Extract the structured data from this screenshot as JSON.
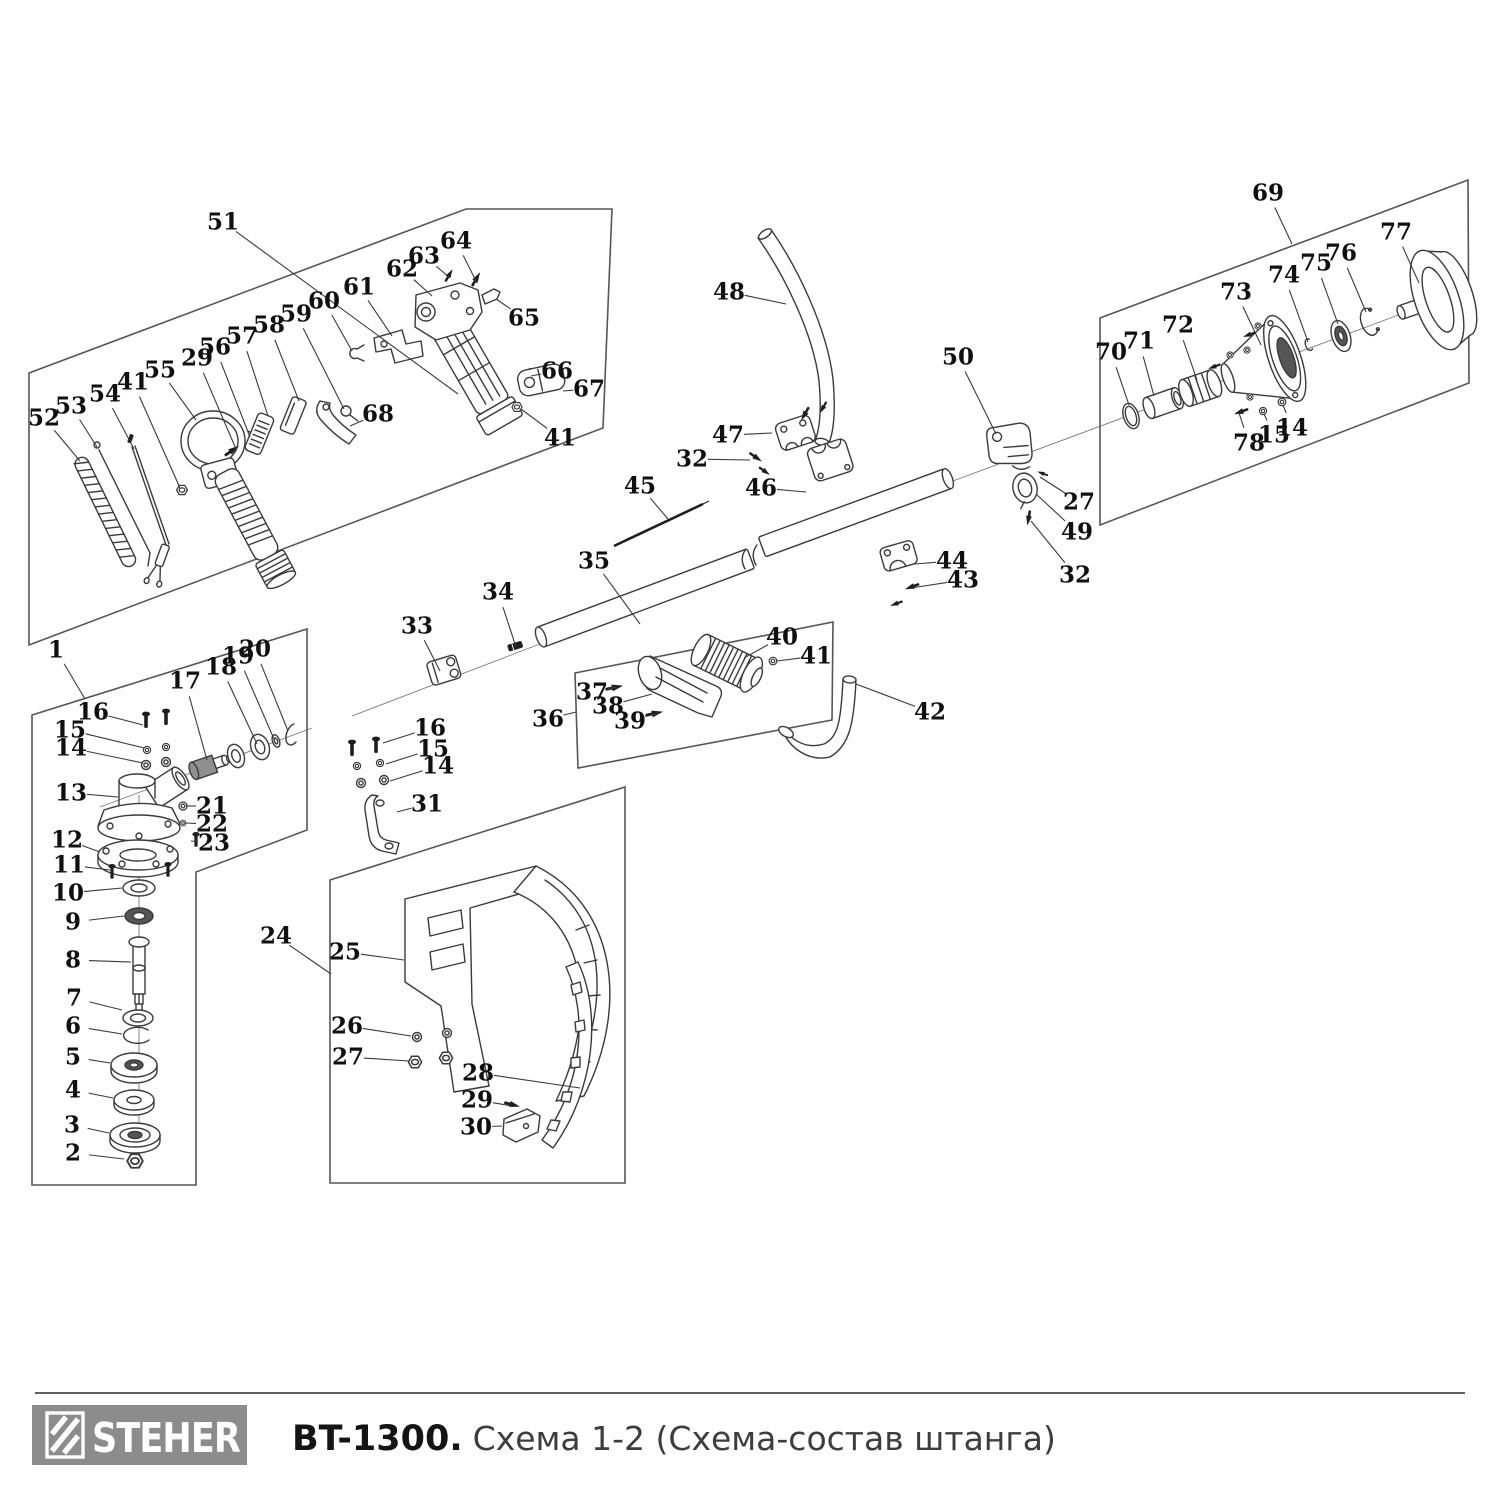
{
  "footer": {
    "brand": "STEHER",
    "model": "BT-1300.",
    "subtitle": "Схема 1-2 (Схема-состав штанга)",
    "logo_bg": "#8c8c8c",
    "line_color": "#2b2b2b"
  },
  "diagram": {
    "description": "Exploded parts diagram of trimmer shaft assembly",
    "stroke_color": "#3a3a3a",
    "callouts": [
      {
        "n": "51",
        "x": 223,
        "y": 222,
        "tx": 458,
        "ty": 394
      },
      {
        "n": "64",
        "x": 456,
        "y": 241,
        "tx": 477,
        "ty": 283
      },
      {
        "n": "63",
        "x": 424,
        "y": 256,
        "tx": 449,
        "ty": 277
      },
      {
        "n": "62",
        "x": 402,
        "y": 269,
        "tx": 432,
        "ty": 296
      },
      {
        "n": "61",
        "x": 359,
        "y": 287,
        "tx": 392,
        "ty": 336
      },
      {
        "n": "60",
        "x": 324,
        "y": 301,
        "tx": 352,
        "ty": 351
      },
      {
        "n": "59",
        "x": 296,
        "y": 314,
        "tx": 344,
        "ty": 409
      },
      {
        "n": "58",
        "x": 269,
        "y": 325,
        "tx": 299,
        "ty": 401
      },
      {
        "n": "57",
        "x": 242,
        "y": 336,
        "tx": 268,
        "ty": 416
      },
      {
        "n": "56",
        "x": 215,
        "y": 347,
        "tx": 250,
        "ty": 437
      },
      {
        "n": "29",
        "x": 197,
        "y": 358,
        "tx": 236,
        "ty": 449
      },
      {
        "n": "55",
        "x": 160,
        "y": 370,
        "tx": 196,
        "ty": 420
      },
      {
        "n": "41",
        "x": 133,
        "y": 382,
        "tx": 180,
        "ty": 488
      },
      {
        "n": "54",
        "x": 105,
        "y": 394,
        "tx": 134,
        "ty": 449
      },
      {
        "n": "53",
        "x": 71,
        "y": 406,
        "tx": 97,
        "ty": 447
      },
      {
        "n": "52",
        "x": 44,
        "y": 418,
        "tx": 80,
        "ty": 461
      },
      {
        "n": "65",
        "x": 524,
        "y": 318,
        "tx": 496,
        "ty": 299
      },
      {
        "n": "66",
        "x": 557,
        "y": 371,
        "tx": 531,
        "ty": 376
      },
      {
        "n": "67",
        "x": 589,
        "y": 389,
        "tx": 563,
        "ty": 391
      },
      {
        "n": "68",
        "x": 378,
        "y": 414,
        "tx": 350,
        "ty": 426
      },
      {
        "n": "41",
        "x": 560,
        "y": 438,
        "tx": 521,
        "ty": 409
      },
      {
        "n": "1",
        "x": 56,
        "y": 650,
        "tx": 85,
        "ty": 699
      },
      {
        "n": "16",
        "x": 93,
        "y": 712,
        "tx": 143,
        "ty": 725
      },
      {
        "n": "15",
        "x": 70,
        "y": 730,
        "tx": 144,
        "ty": 748
      },
      {
        "n": "14",
        "x": 71,
        "y": 748,
        "tx": 143,
        "ty": 763
      },
      {
        "n": "17",
        "x": 185,
        "y": 681,
        "tx": 207,
        "ty": 760
      },
      {
        "n": "18",
        "x": 221,
        "y": 667,
        "tx": 257,
        "ty": 744
      },
      {
        "n": "19",
        "x": 238,
        "y": 656,
        "tx": 274,
        "ty": 739
      },
      {
        "n": "20",
        "x": 255,
        "y": 649,
        "tx": 288,
        "ty": 731
      },
      {
        "n": "13",
        "x": 71,
        "y": 793,
        "tx": 118,
        "ty": 797
      },
      {
        "n": "21",
        "x": 212,
        "y": 806,
        "tx": 186,
        "ty": 806
      },
      {
        "n": "22",
        "x": 212,
        "y": 824,
        "tx": 185,
        "ty": 823
      },
      {
        "n": "23",
        "x": 214,
        "y": 843,
        "tx": 191,
        "ty": 841
      },
      {
        "n": "12",
        "x": 67,
        "y": 840,
        "tx": 100,
        "ty": 852
      },
      {
        "n": "11",
        "x": 69,
        "y": 865,
        "tx": 110,
        "ty": 870
      },
      {
        "n": "10",
        "x": 68,
        "y": 893,
        "tx": 122,
        "ty": 888
      },
      {
        "n": "9",
        "x": 73,
        "y": 922,
        "tx": 124,
        "ty": 916
      },
      {
        "n": "8",
        "x": 73,
        "y": 960,
        "tx": 131,
        "ty": 962
      },
      {
        "n": "7",
        "x": 74,
        "y": 998,
        "tx": 122,
        "ty": 1010
      },
      {
        "n": "6",
        "x": 73,
        "y": 1026,
        "tx": 122,
        "ty": 1034
      },
      {
        "n": "5",
        "x": 73,
        "y": 1057,
        "tx": 110,
        "ty": 1063
      },
      {
        "n": "4",
        "x": 73,
        "y": 1090,
        "tx": 113,
        "ty": 1098
      },
      {
        "n": "3",
        "x": 72,
        "y": 1125,
        "tx": 109,
        "ty": 1133
      },
      {
        "n": "2",
        "x": 73,
        "y": 1153,
        "tx": 124,
        "ty": 1159
      },
      {
        "n": "24",
        "x": 276,
        "y": 936,
        "tx": 331,
        "ty": 974
      },
      {
        "n": "33",
        "x": 417,
        "y": 626,
        "tx": 440,
        "ty": 671
      },
      {
        "n": "34",
        "x": 498,
        "y": 592,
        "tx": 516,
        "ty": 647
      },
      {
        "n": "35",
        "x": 594,
        "y": 561,
        "tx": 640,
        "ty": 624
      },
      {
        "n": "45",
        "x": 640,
        "y": 486,
        "tx": 668,
        "ty": 519
      },
      {
        "n": "16",
        "x": 430,
        "y": 728,
        "tx": 383,
        "ty": 743
      },
      {
        "n": "15",
        "x": 433,
        "y": 749,
        "tx": 386,
        "ty": 764
      },
      {
        "n": "14",
        "x": 438,
        "y": 766,
        "tx": 390,
        "ty": 781
      },
      {
        "n": "31",
        "x": 427,
        "y": 804,
        "tx": 397,
        "ty": 812
      },
      {
        "n": "36",
        "x": 548,
        "y": 719,
        "tx": 576,
        "ty": 712
      },
      {
        "n": "37",
        "x": 592,
        "y": 692,
        "tx": 616,
        "ty": 687
      },
      {
        "n": "38",
        "x": 608,
        "y": 706,
        "tx": 652,
        "ty": 694
      },
      {
        "n": "39",
        "x": 630,
        "y": 721,
        "tx": 658,
        "ty": 713
      },
      {
        "n": "40",
        "x": 782,
        "y": 637,
        "tx": 744,
        "ty": 658
      },
      {
        "n": "41",
        "x": 816,
        "y": 656,
        "tx": 777,
        "ty": 661
      },
      {
        "n": "42",
        "x": 930,
        "y": 712,
        "tx": 856,
        "ty": 684
      },
      {
        "n": "48",
        "x": 729,
        "y": 292,
        "tx": 786,
        "ty": 304
      },
      {
        "n": "47",
        "x": 728,
        "y": 435,
        "tx": 772,
        "ty": 433
      },
      {
        "n": "32",
        "x": 692,
        "y": 459,
        "tx": 750,
        "ty": 460
      },
      {
        "n": "46",
        "x": 761,
        "y": 488,
        "tx": 806,
        "ty": 492
      },
      {
        "n": "50",
        "x": 958,
        "y": 357,
        "tx": 996,
        "ty": 434
      },
      {
        "n": "27",
        "x": 1079,
        "y": 502,
        "tx": 1040,
        "ty": 477
      },
      {
        "n": "49",
        "x": 1077,
        "y": 532,
        "tx": 1036,
        "ty": 494
      },
      {
        "n": "32",
        "x": 1075,
        "y": 575,
        "tx": 1031,
        "ty": 521
      },
      {
        "n": "44",
        "x": 952,
        "y": 561,
        "tx": 915,
        "ty": 564
      },
      {
        "n": "43",
        "x": 963,
        "y": 580,
        "tx": 911,
        "ty": 588
      },
      {
        "n": "25",
        "x": 345,
        "y": 952,
        "tx": 404,
        "ty": 960
      },
      {
        "n": "26",
        "x": 347,
        "y": 1026,
        "tx": 411,
        "ty": 1036
      },
      {
        "n": "27",
        "x": 348,
        "y": 1057,
        "tx": 409,
        "ty": 1061
      },
      {
        "n": "28",
        "x": 478,
        "y": 1073,
        "tx": 580,
        "ty": 1088
      },
      {
        "n": "29",
        "x": 477,
        "y": 1100,
        "tx": 512,
        "ty": 1106
      },
      {
        "n": "30",
        "x": 476,
        "y": 1127,
        "tx": 502,
        "ty": 1126
      },
      {
        "n": "69",
        "x": 1268,
        "y": 193,
        "tx": 1292,
        "ty": 244
      },
      {
        "n": "70",
        "x": 1111,
        "y": 352,
        "tx": 1129,
        "ty": 405
      },
      {
        "n": "71",
        "x": 1139,
        "y": 341,
        "tx": 1154,
        "ty": 396
      },
      {
        "n": "72",
        "x": 1178,
        "y": 325,
        "tx": 1197,
        "ty": 380
      },
      {
        "n": "73",
        "x": 1236,
        "y": 292,
        "tx": 1261,
        "ty": 345
      },
      {
        "n": "74",
        "x": 1284,
        "y": 275,
        "tx": 1308,
        "ty": 342
      },
      {
        "n": "75",
        "x": 1316,
        "y": 263,
        "tx": 1338,
        "ty": 324
      },
      {
        "n": "76",
        "x": 1341,
        "y": 253,
        "tx": 1366,
        "ty": 312
      },
      {
        "n": "77",
        "x": 1396,
        "y": 232,
        "tx": 1419,
        "ty": 283
      },
      {
        "n": "78",
        "x": 1249,
        "y": 443,
        "tx": 1239,
        "ty": 413
      },
      {
        "n": "15",
        "x": 1274,
        "y": 435,
        "tx": 1264,
        "ty": 414
      },
      {
        "n": "14",
        "x": 1292,
        "y": 428,
        "tx": 1283,
        "ty": 405
      }
    ]
  }
}
